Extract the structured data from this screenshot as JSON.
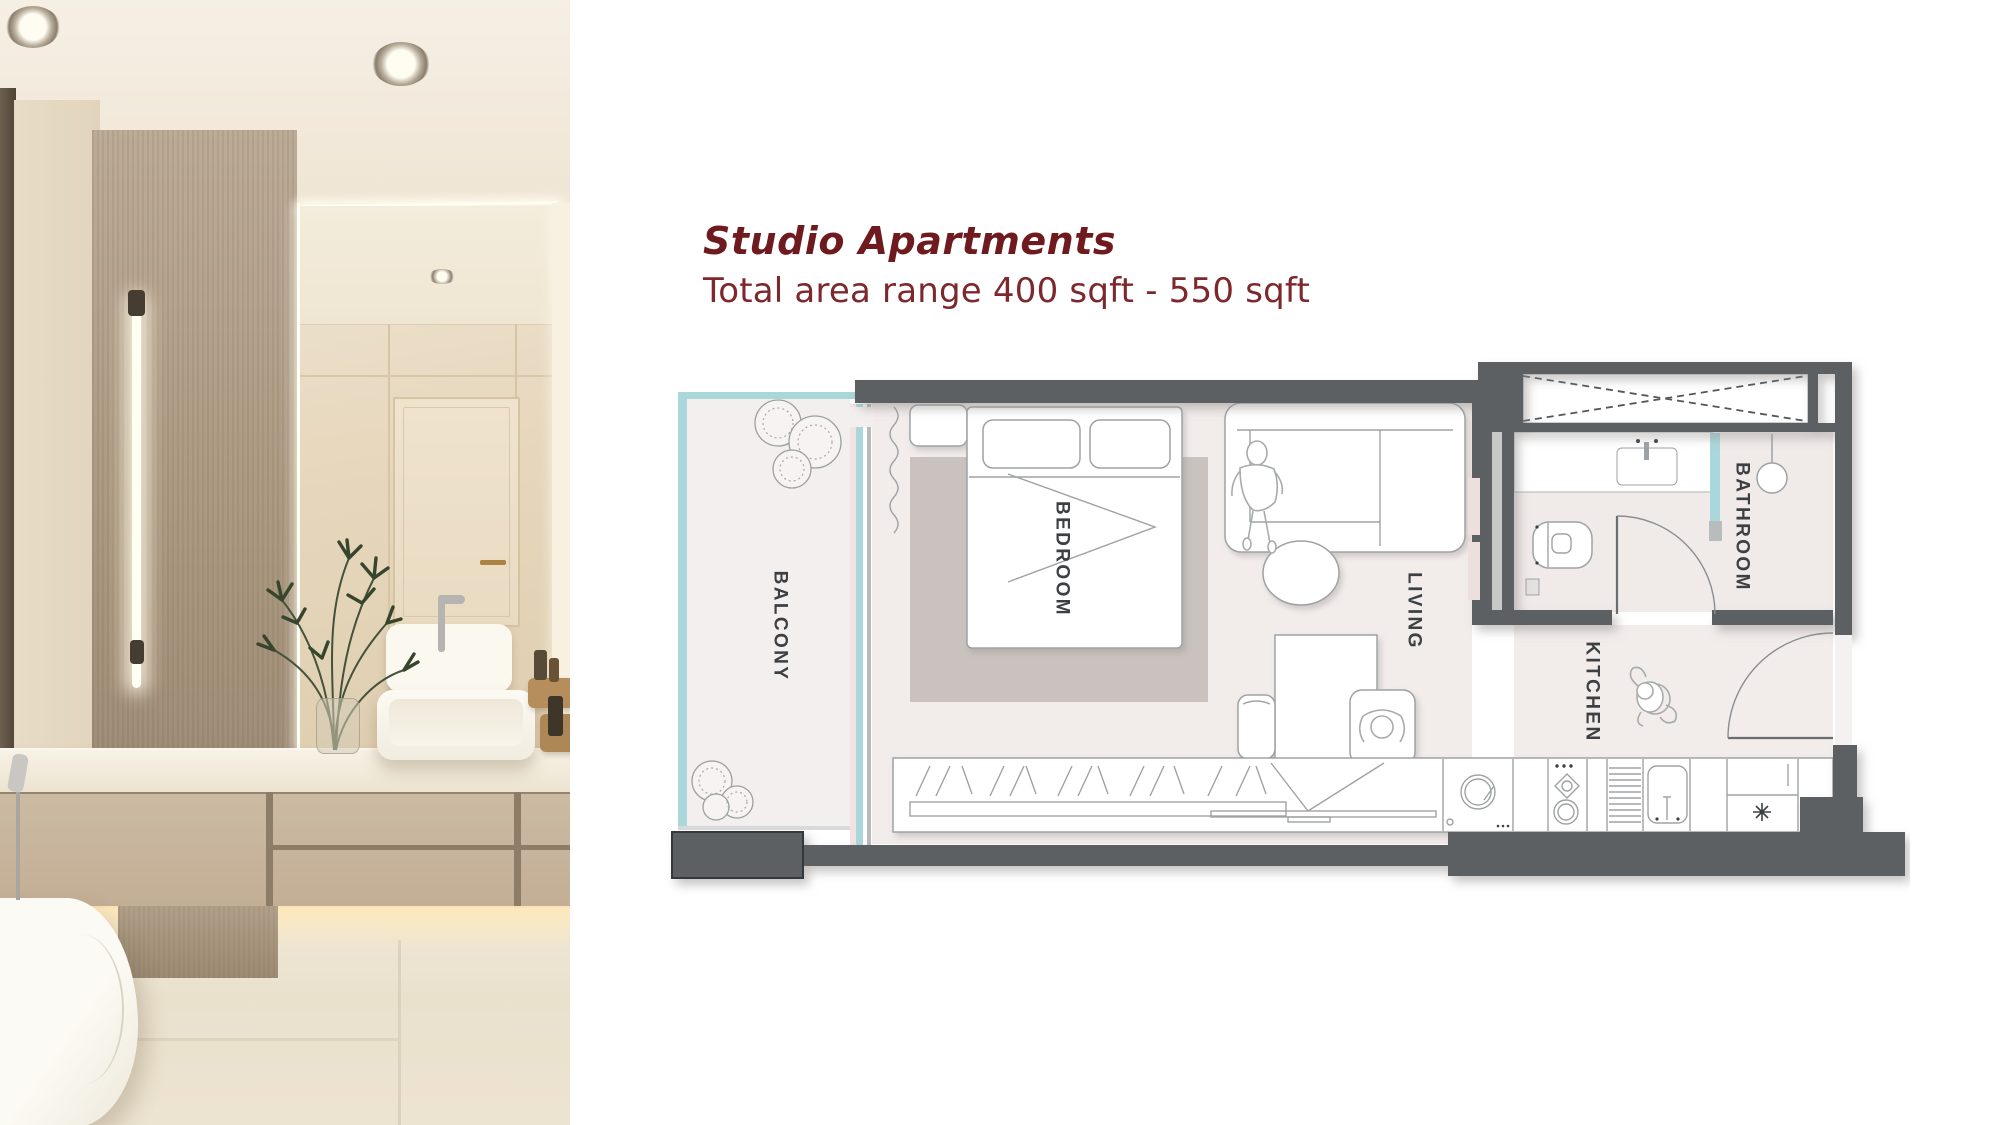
{
  "header": {
    "title": "Studio Apartments",
    "subtitle": "Total area range 400 sqft - 550 sqft"
  },
  "floorplan": {
    "rooms": [
      {
        "key": "balcony",
        "label": "BALCONY"
      },
      {
        "key": "bedroom",
        "label": "BEDROOM"
      },
      {
        "key": "living",
        "label": "LIVING"
      },
      {
        "key": "bathroom",
        "label": "BATHROOM"
      },
      {
        "key": "kitchen",
        "label": "KITCHEN"
      }
    ],
    "icons": [
      "bed-icon",
      "pillow-icon",
      "rug-icon",
      "curtain-icon",
      "sofa-icon",
      "person-standing-icon",
      "coffee-table-icon",
      "dining-table-icon",
      "chair-icon",
      "person-sitting-icon",
      "wardrobe-sliding-icon",
      "tv-icon",
      "washing-machine-icon",
      "stove-icon",
      "dish-rack-icon",
      "kitchen-sink-icon",
      "fridge-snowflake-icon",
      "vanity-sink-icon",
      "toilet-icon",
      "ceiling-light-icon",
      "towel-rail-icon",
      "closet-cross-icon",
      "door-swing-icon",
      "plant-icon"
    ],
    "colors": {
      "wall": "#5c6063",
      "floor": "#f2eceb",
      "balcony_floor": "#f4efef",
      "rug": "#c9c2bf",
      "teal_glass": "#aad7da",
      "label": "#3d4043",
      "line": "#9fa2a4"
    }
  },
  "photo": {
    "name": "bathroom-interior-photo"
  },
  "accent": {
    "title_color": "#6e1a1e",
    "subtitle_color": "#7c282c"
  }
}
